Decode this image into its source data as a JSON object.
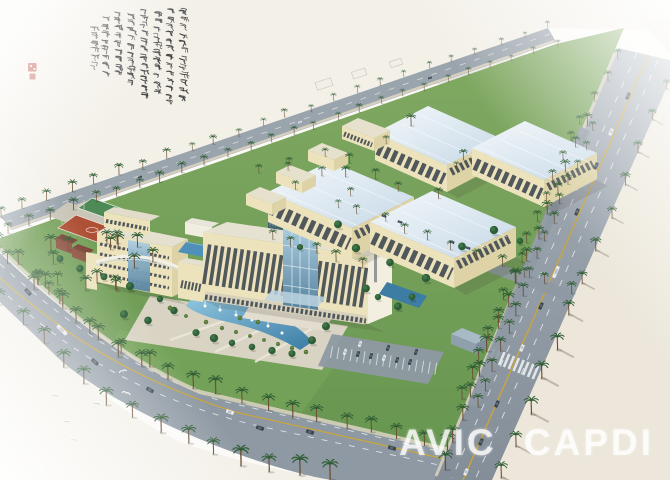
{
  "watermark": {
    "text": "AVIC CAPDI"
  },
  "inscription": {
    "script": "chinese-cursive-calligraphy",
    "columns": 8,
    "seal_marks": 2
  },
  "scene": {
    "type": "aerial-architectural-rendering",
    "warehouses": 4,
    "flagpoles": 3,
    "sports_courts": 2
  },
  "palette": {
    "paper": "#fbfaf7",
    "grass": "#6f9d54",
    "grassLight": "#7cab5e",
    "road": "#8e99a3",
    "roadFar": "#9aa4ad",
    "sand": "#ece7da",
    "sandLight": "#f3f0e8",
    "wall": "#ece3bc",
    "wallShade": "#ddd3a6",
    "roofA": "#f2f7fa",
    "roofB": "#c9dbe8",
    "glassA": "#aecfe0",
    "glassB": "#54819e",
    "water": "#4f90b8",
    "courtRed": "#ae5036",
    "courtGreen": "#4e8a55",
    "palmGreen": "#2f5c33",
    "treeDark": "#2e5e38",
    "trunk": "#6b5136",
    "ink": "#3a393c",
    "seal": "#b5372b",
    "laneYellow": "#c9a53e"
  }
}
